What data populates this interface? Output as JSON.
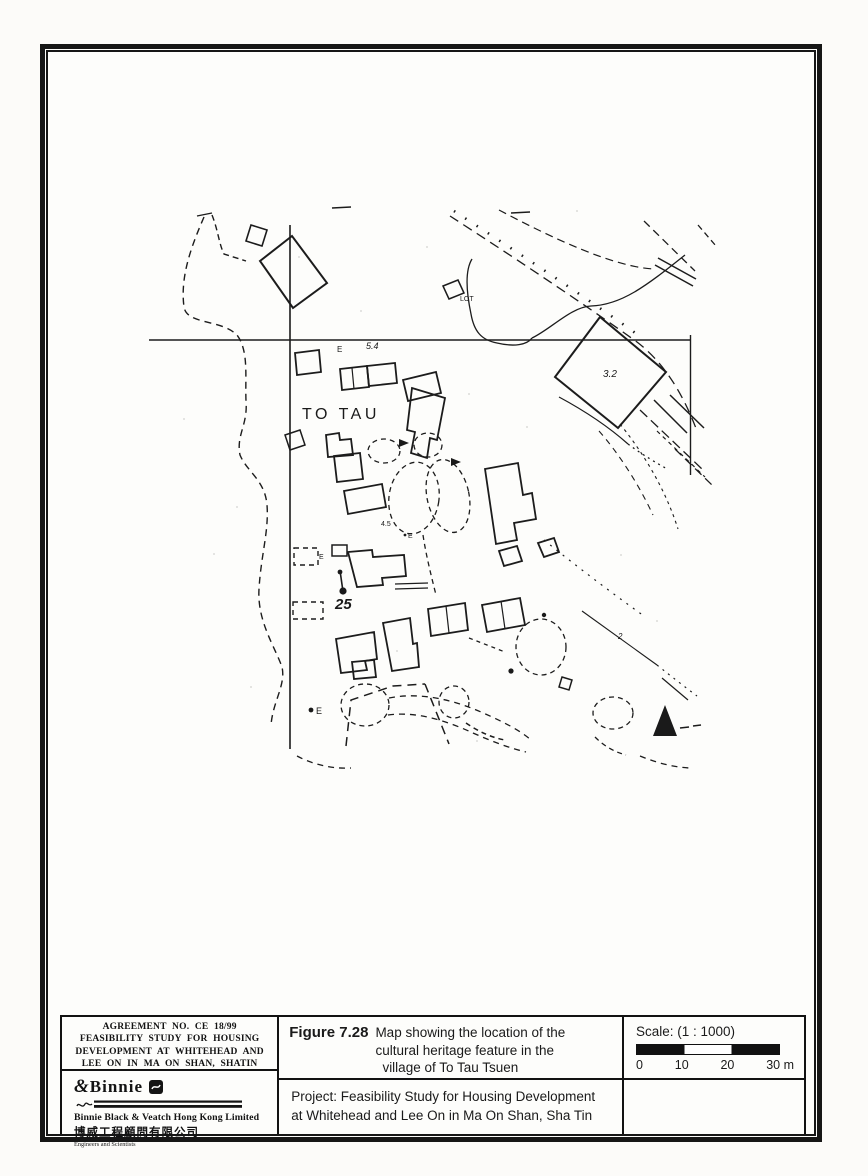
{
  "colors": {
    "ink": "#1a1a1a",
    "paper": "#fcfbf9"
  },
  "map": {
    "village_label": "TO TAU",
    "feature_marker": "25",
    "lot_label": "LOT",
    "spot_e_upper": "E",
    "spot_54": "5.4",
    "spot_32": "3.2",
    "spot_45": "4.5",
    "spot_e_mid": "E",
    "spot_e_small": "E",
    "spot_e_lower": "E",
    "spot_2": "2"
  },
  "title_block": {
    "agreement": {
      "line1": "AGREEMENT NO. CE 18/99",
      "line2": "FEASIBILITY STUDY FOR HOUSING",
      "line3": "DEVELOPMENT AT WHITEHEAD AND",
      "line4": "LEE ON IN MA ON SHAN, SHATIN"
    },
    "company": {
      "logo_amp": "&",
      "logo_name": "Binnie",
      "name_english": "Binnie Black & Veatch Hong Kong Limited",
      "name_chinese": "博威工程顧問有限公司",
      "tagline": "Engineers and Scientists"
    },
    "figure": {
      "label": "Figure 7.28",
      "caption_line1": "Map showing the location of the",
      "caption_line2": "cultural heritage feature in the",
      "caption_line3": "village of To Tau Tsuen"
    },
    "project": {
      "line1": "Project: Feasibility Study for Housing Development",
      "line2": "at Whitehead and Lee On in Ma On Shan, Sha Tin"
    },
    "scale": {
      "label": "Scale: (1 : 1000)",
      "tick0": "0",
      "tick1": "10",
      "tick2": "20",
      "tick3": "30 m"
    }
  }
}
